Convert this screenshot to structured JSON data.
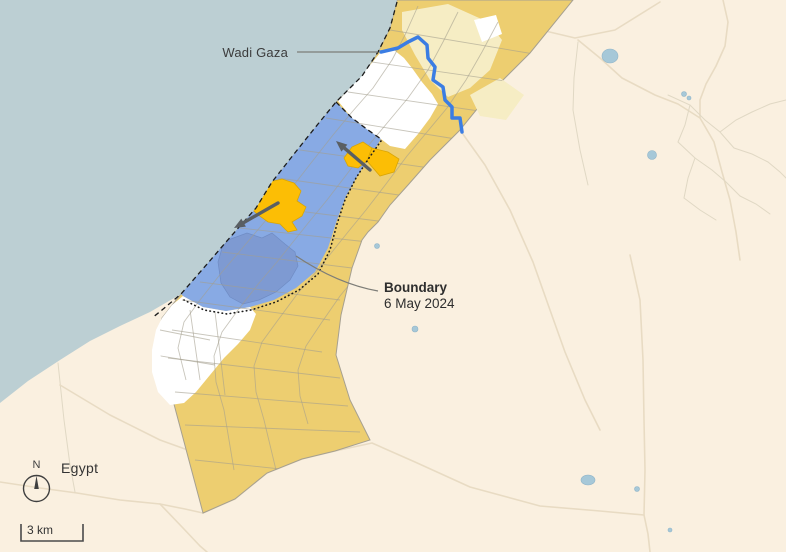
{
  "map": {
    "annotations": {
      "wadi_gaza": "Wadi Gaza",
      "boundary": {
        "title": "Boundary",
        "date": "6 May 2024"
      },
      "egypt": "Egypt"
    },
    "compass": {
      "north": "N"
    },
    "scale_bar": {
      "label": "3 km"
    },
    "colors": {
      "sea": "#bccfd3",
      "land": "#faf0e0",
      "district_gold": "#edce70",
      "district_pale": "#f6edc4",
      "district_white": "#ffffff",
      "zone_blue": "#88aae4",
      "zone_blue_dark": "#7e9ad2",
      "highlight_orange": "#fcbe05",
      "river_blue": "#3b7de3",
      "arrow_gray": "#5a5f63"
    }
  }
}
